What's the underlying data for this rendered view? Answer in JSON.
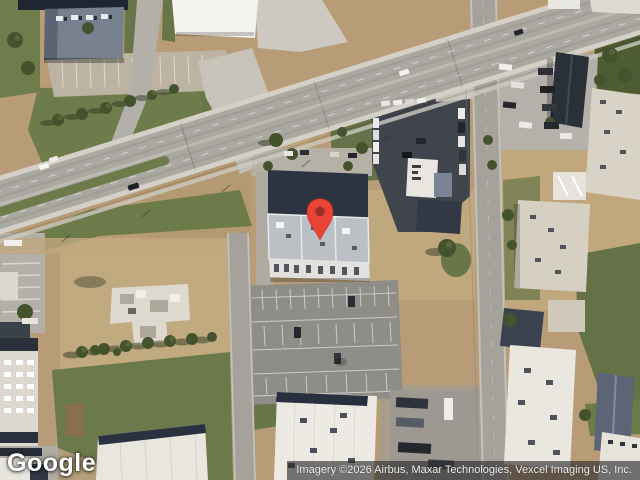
{
  "map": {
    "view_type": "satellite",
    "watermark": {
      "label": "Google"
    },
    "attribution": {
      "text": "Imagery ©2026 Airbus, Maxar Technologies, Vexcel Imaging US, Inc."
    },
    "marker": {
      "name": "location-pin",
      "color": "#EA4335",
      "outline_color": "#B3271B",
      "dot_color": "#9A2F23",
      "position": {
        "x": 320,
        "y": 240
      }
    },
    "palette": {
      "dirt": "#b79c77",
      "dirt_light": "#c2aa80",
      "grass": "#6e7b4b",
      "grass_dark": "#4e5c33",
      "road_asphalt": "#aba8a1",
      "road_concrete": "#d4d0c8",
      "parking_asphalt": "#8e8d87",
      "parking_dark": "#40454d",
      "roof_white": "#e9e6df",
      "roof_beige": "#d8d3c6",
      "roof_dark_navy": "#2c3442",
      "roof_blue_gray": "#76808f"
    }
  }
}
